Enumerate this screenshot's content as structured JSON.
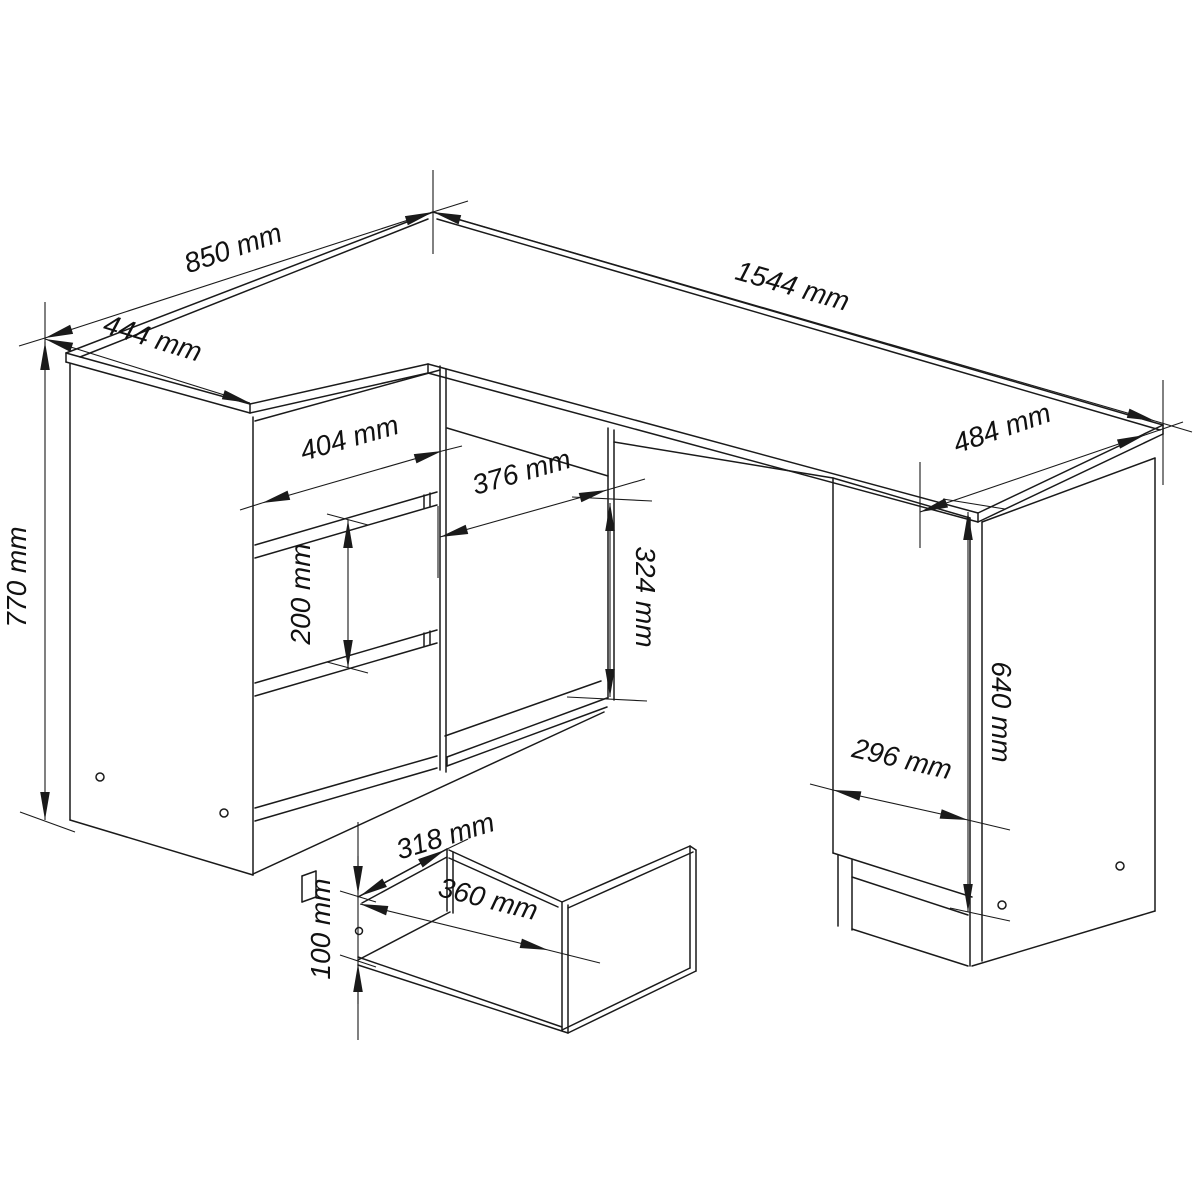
{
  "diagram": {
    "colors": {
      "line": "#1a1a1a",
      "background": "#ffffff"
    },
    "dimensions": {
      "d850": "850 mm",
      "d444": "444 mm",
      "d1544": "1544 mm",
      "d484": "484 mm",
      "d404": "404 mm",
      "d376": "376 mm",
      "d324": "324 mm",
      "d200": "200 mm",
      "d770": "770 mm",
      "d640": "640 mm",
      "d296": "296 mm",
      "d318": "318 mm",
      "d360": "360 mm",
      "d100": "100 mm"
    }
  }
}
